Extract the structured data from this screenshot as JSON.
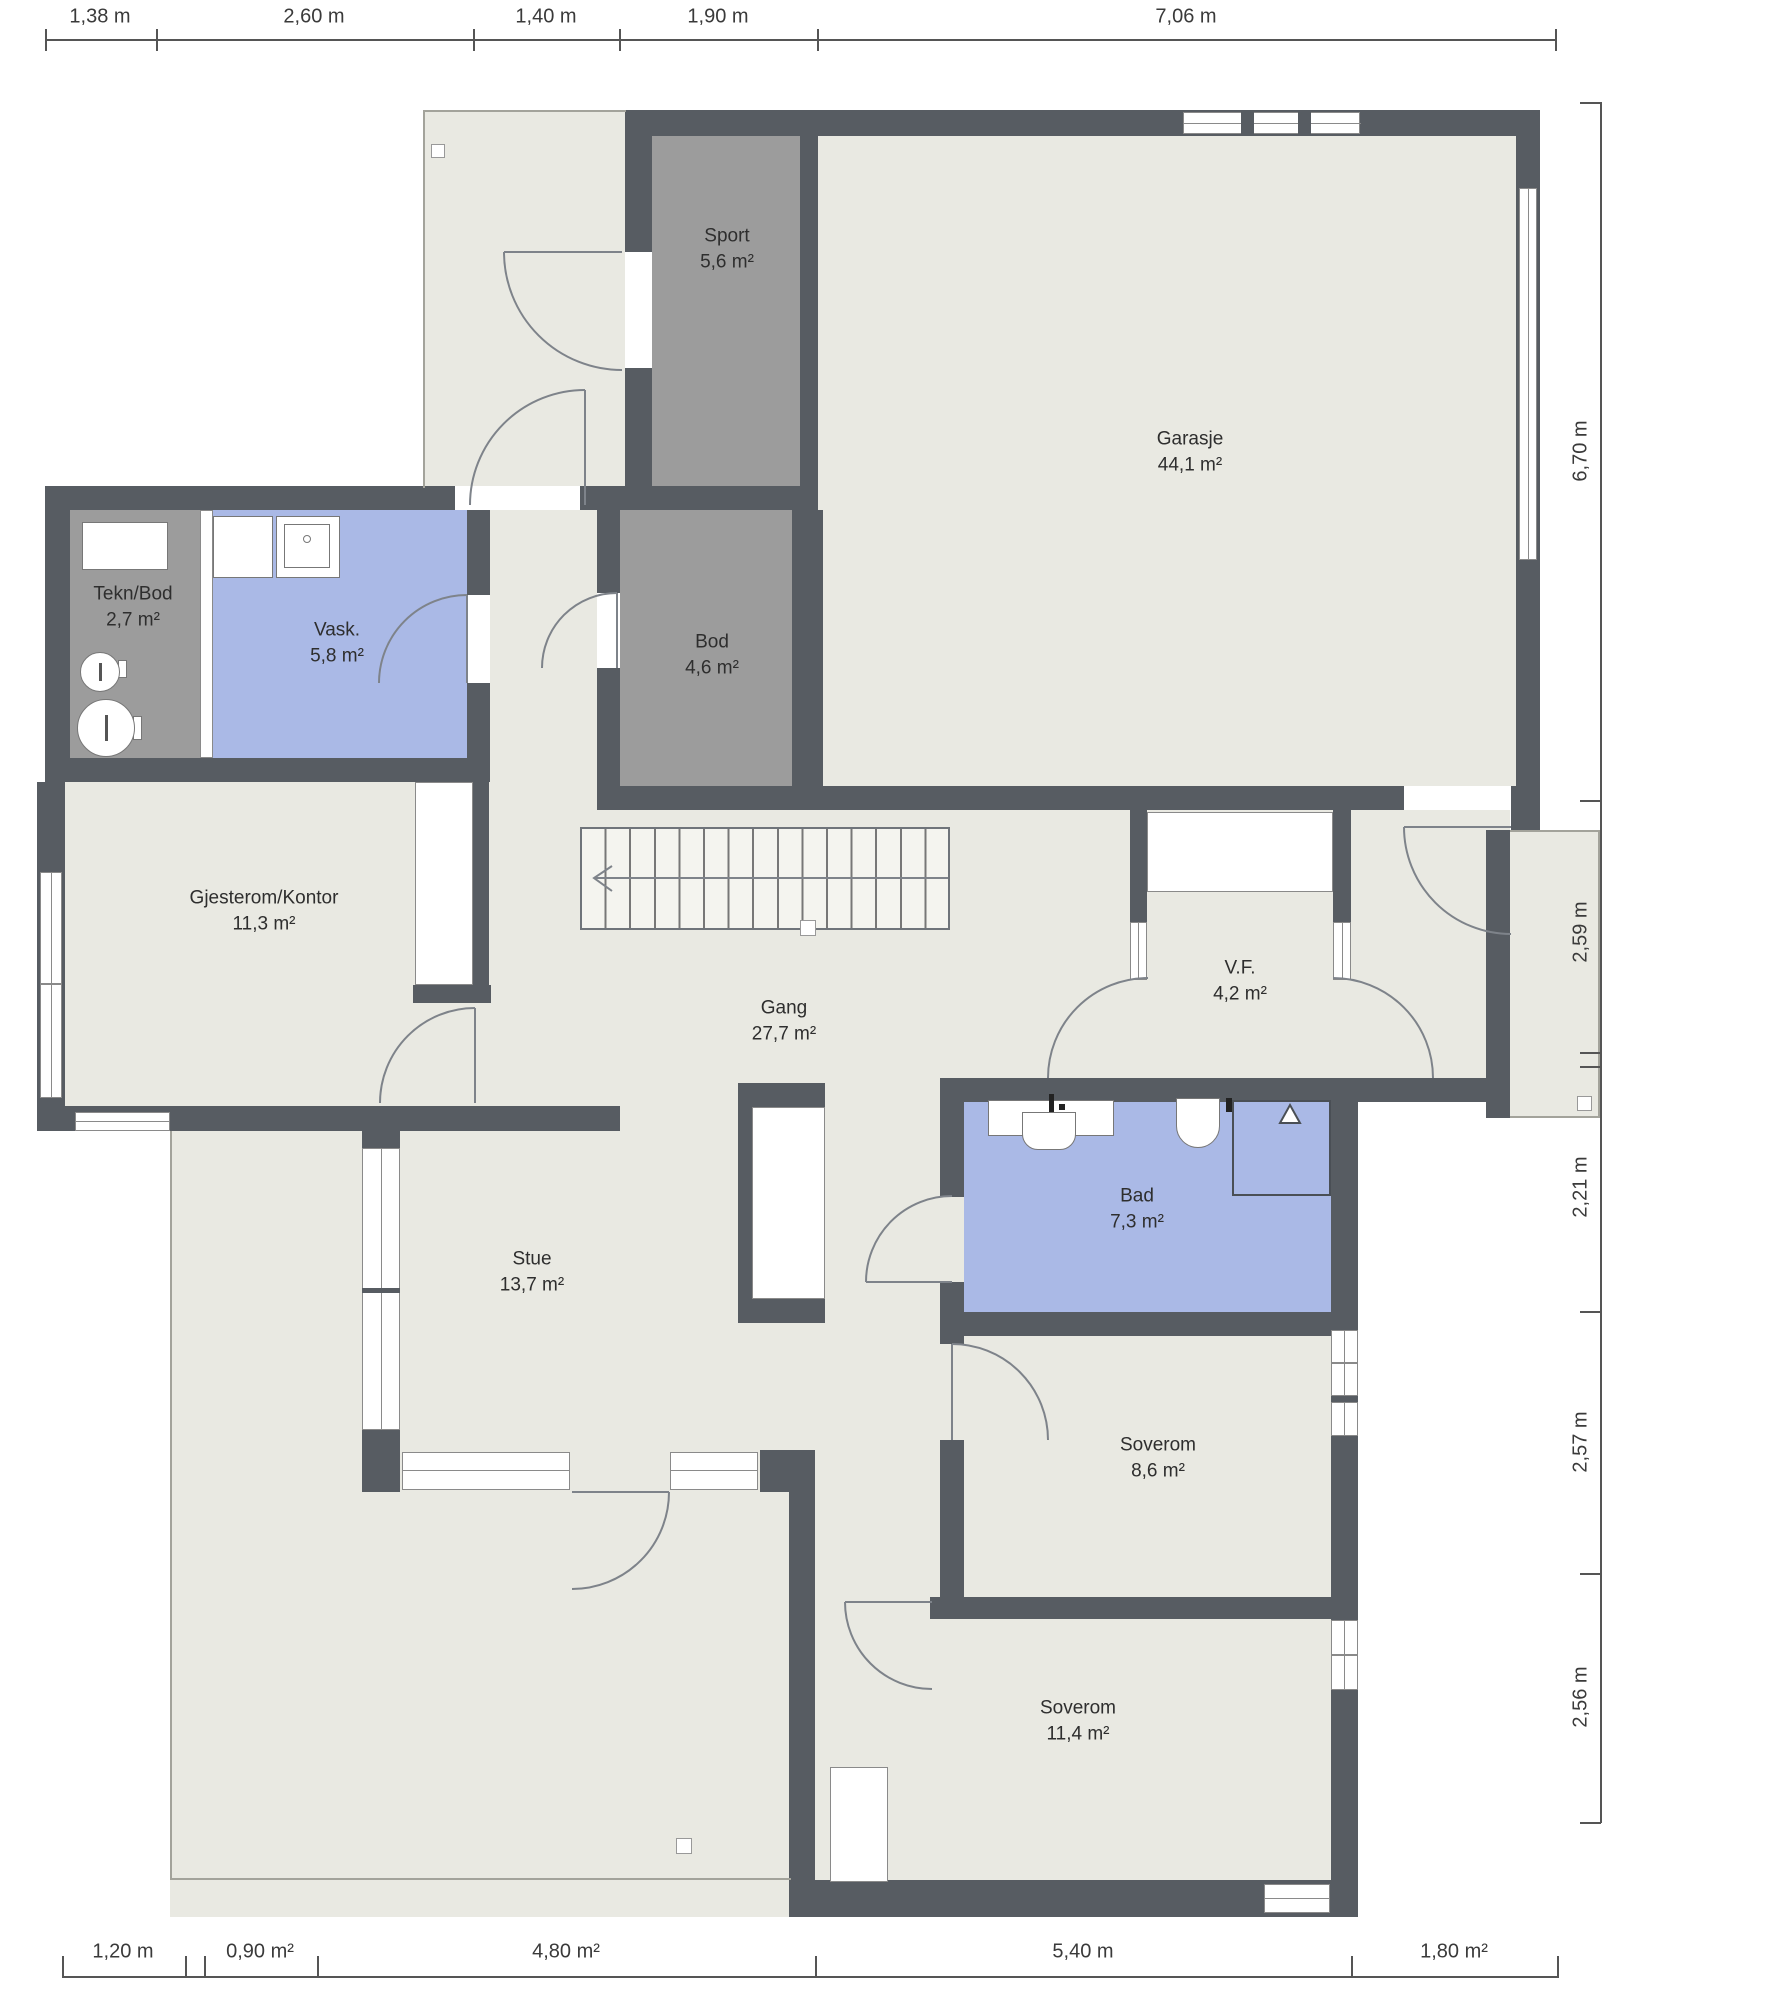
{
  "colors": {
    "wall": "#575c62",
    "floor": "#e9e9e2",
    "storage": "#9c9c9c",
    "wet": "#aab9e6",
    "outline": "#a3a39b",
    "frame": "#8a8a8a",
    "dim": "#3a3a3a",
    "label": "#2e2e2e"
  },
  "plan": {
    "rooms": [
      {
        "id": "sport",
        "name": "Sport",
        "area": "5,6 m²"
      },
      {
        "id": "garasje",
        "name": "Garasje",
        "area": "44,1 m²"
      },
      {
        "id": "tekn-bod",
        "name": "Tekn/Bod",
        "area": "2,7 m²"
      },
      {
        "id": "vask",
        "name": "Vask.",
        "area": "5,8 m²"
      },
      {
        "id": "bod",
        "name": "Bod",
        "area": "4,6 m²"
      },
      {
        "id": "gjesterom",
        "name": "Gjesterom/Kontor",
        "area": "11,3 m²"
      },
      {
        "id": "gang",
        "name": "Gang",
        "area": "27,7 m²"
      },
      {
        "id": "vf",
        "name": "V.F.",
        "area": "4,2 m²"
      },
      {
        "id": "bad",
        "name": "Bad",
        "area": "7,3 m²"
      },
      {
        "id": "stue",
        "name": "Stue",
        "area": "13,7 m²"
      },
      {
        "id": "soverom-1",
        "name": "Soverom",
        "area": "8,6 m²"
      },
      {
        "id": "soverom-2",
        "name": "Soverom",
        "area": "11,4 m²"
      }
    ],
    "stairs": {
      "arrow_direction": "left"
    }
  },
  "dimensions": {
    "top": [
      "1,38 m",
      "2,60 m",
      "1,40 m",
      "1,90 m",
      "7,06 m"
    ],
    "right": [
      "6,70 m",
      "2,59 m",
      "2,21 m",
      "2,57 m",
      "2,56 m"
    ],
    "bottom": [
      "1,20 m",
      "0,90 m²",
      "4,80 m²",
      "5,40 m",
      "1,80 m²"
    ]
  }
}
